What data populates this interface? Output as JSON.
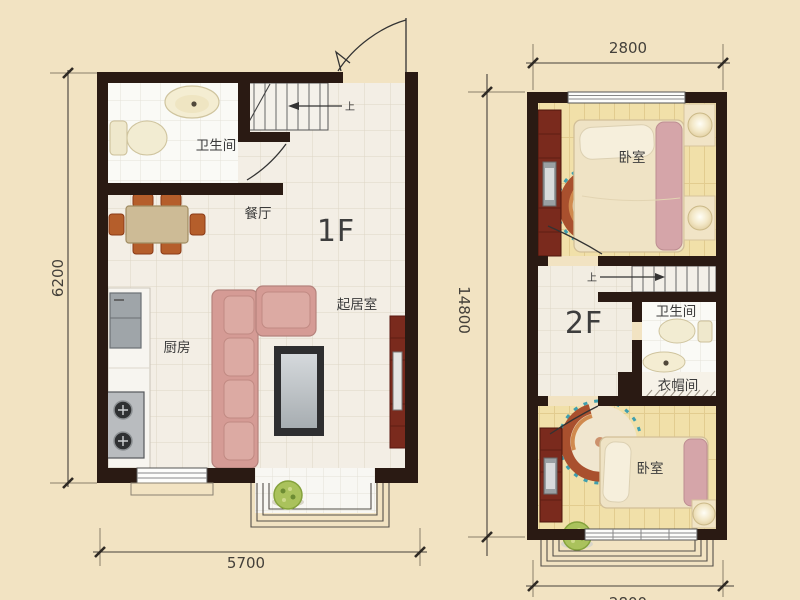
{
  "palette": {
    "bg": "#f2e3c2",
    "wall": "#2a1a13",
    "dim-line": "#45403a",
    "tile-cream": "#f3eee5",
    "tile-white": "#fafaf6",
    "wood-floor": "#f1e0a9",
    "sofa-pink": "#d59b95",
    "blanket-pink": "#d5a5a9",
    "bed-cream": "#efe3c5",
    "cabinet-darkred": "#7a2a1d",
    "table-tan": "#cdbb96",
    "chair-orange": "#b55e2b",
    "appliance-gray": "#a4a8ab",
    "plant-green": "#aac25c",
    "rug-red": "#a9502e",
    "rug-gold": "#d08a4e",
    "rug-blue": "#3f9fae"
  },
  "plan_1f": {
    "floor_label": "1F",
    "rooms": {
      "bathroom": "卫生间",
      "dining": "餐厅",
      "living": "起居室",
      "kitchen": "厨房"
    },
    "stairs_up": "上",
    "dim_height": "6200",
    "dim_width": "5700"
  },
  "plan_2f": {
    "floor_label": "2F",
    "rooms": {
      "bedroom_upper": "卧室",
      "bathroom": "卫生间",
      "closet": "衣帽间",
      "bedroom_lower": "卧室"
    },
    "stairs_up": "上",
    "dim_width_top": "2800",
    "dim_height": "14800",
    "dim_width_bottom": "2800"
  }
}
